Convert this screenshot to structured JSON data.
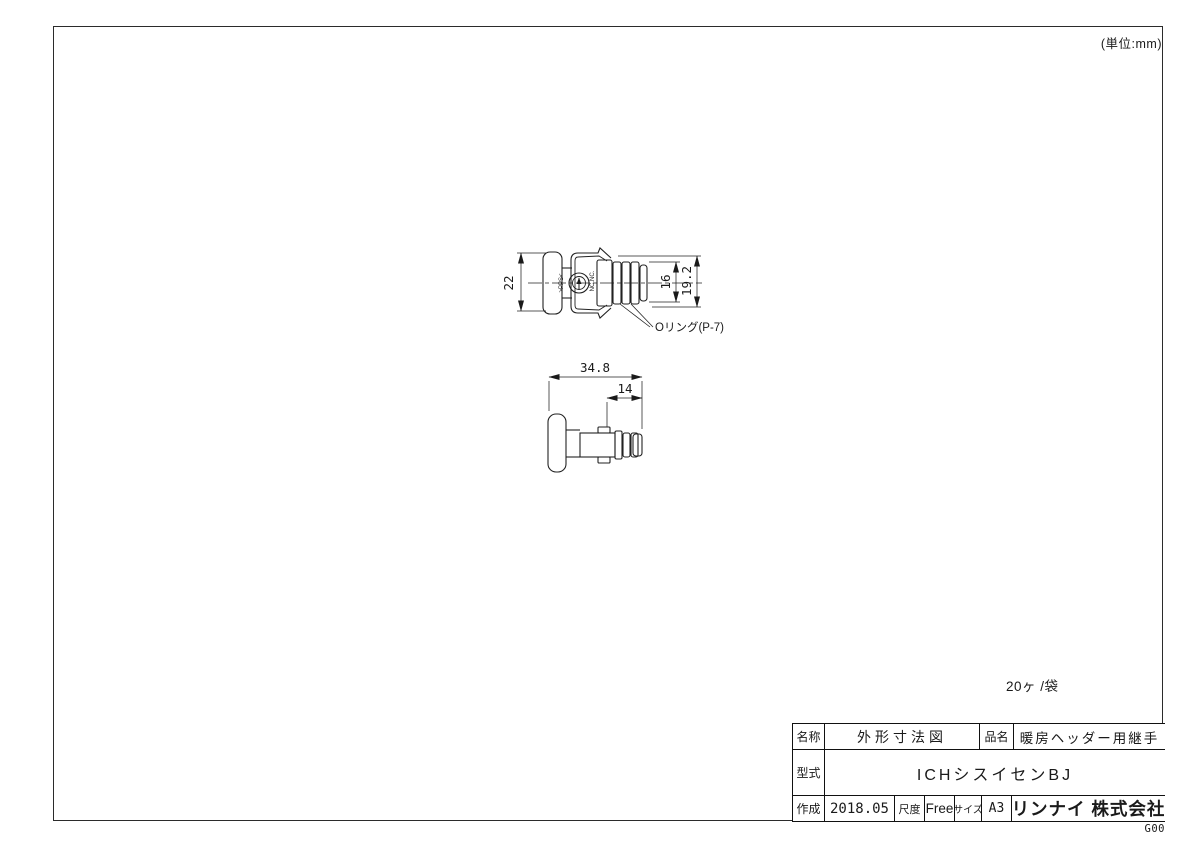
{
  "page": {
    "unit_note": "(単位:mm)",
    "qty_note": "20ヶ /袋",
    "doc_code": "G00"
  },
  "front_view": {
    "dim_flange_od": "22",
    "dim_barb_od": "16",
    "dim_clip_od": "19.2",
    "oring_label": "Oリング(P-7)",
    "material_mark": ">PPS<",
    "mold_mark": "NC.NC."
  },
  "side_view": {
    "dim_overall_length": "34.8",
    "dim_insert_length": "14"
  },
  "title_block": {
    "name_label": "名称",
    "name_value": "外形寸法図",
    "product_label": "品名",
    "product_value": "暖房ヘッダー用継手",
    "model_label": "型式",
    "model_value": "ICHシスイセンBJ",
    "created_label": "作成",
    "created_value": "2018.05",
    "scale_label": "尺度",
    "scale_value": "Free",
    "size_label": "サイズ",
    "size_value": "A3",
    "company": "リンナイ 株式会社"
  }
}
